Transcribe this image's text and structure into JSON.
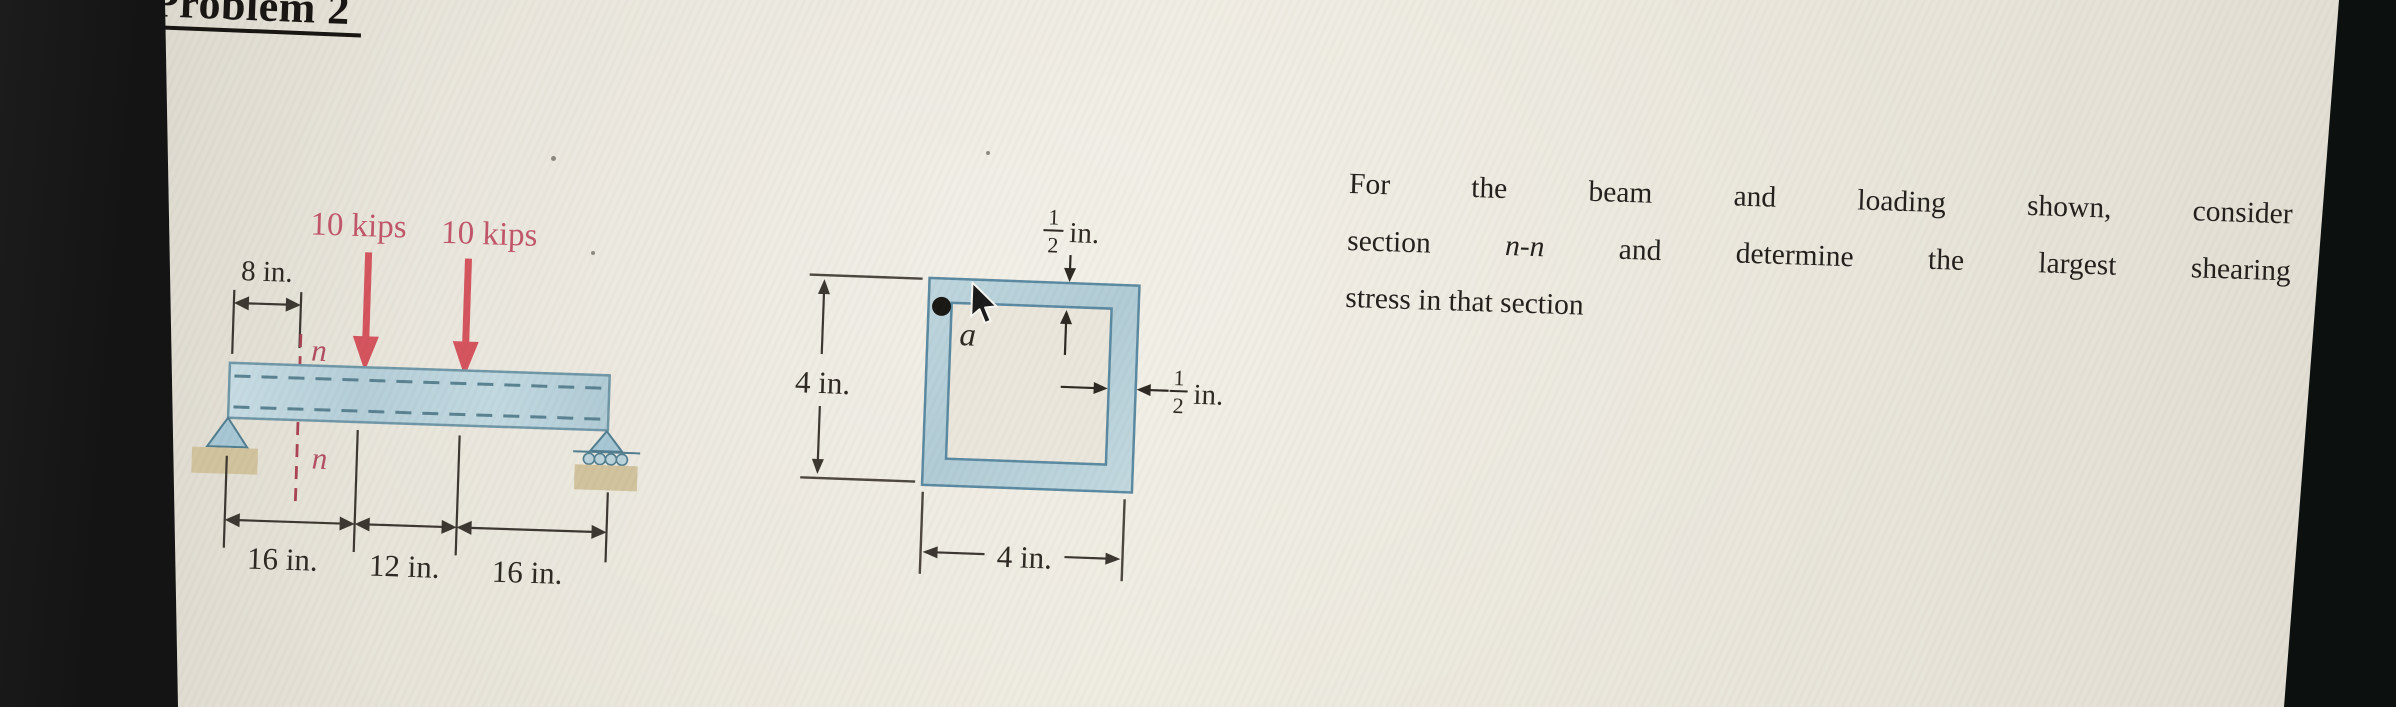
{
  "title": "Problem 2",
  "problem_statement": {
    "line1": "For the beam and loading shown, consider",
    "line2_pre": "section",
    "line2_italic": "n-n",
    "line2_post": "and determine the largest shearing",
    "line3": "stress in that section"
  },
  "beam_figure": {
    "loads": [
      {
        "label": "10 kips"
      },
      {
        "label": "10 kips"
      }
    ],
    "offset_dim": "8 in.",
    "section_line": {
      "top_label": "n",
      "bottom_label": "n"
    },
    "bottom_dims": [
      "16 in.",
      "12 in.",
      "16 in."
    ]
  },
  "section_figure": {
    "point_label": "a",
    "top_thickness": {
      "num": "1",
      "den": "2",
      "unit": "in."
    },
    "right_thickness": {
      "num": "1",
      "den": "2",
      "unit": "in."
    },
    "height_dim": "4 in.",
    "width_dim": "4 in."
  },
  "colors": {
    "slide_bg": "#ebe7dc",
    "bezel_black": "#101010",
    "beam_fill": "#b9d2da",
    "beam_outline": "#6e96a6",
    "load_red": "#d4525c",
    "label_rose": "#c05468",
    "section_red": "#a84052",
    "support_blue": "#a6c6d4",
    "support_tan": "#d0c29b",
    "dim_ink": "#3a342e",
    "text_ink": "#201d19"
  }
}
